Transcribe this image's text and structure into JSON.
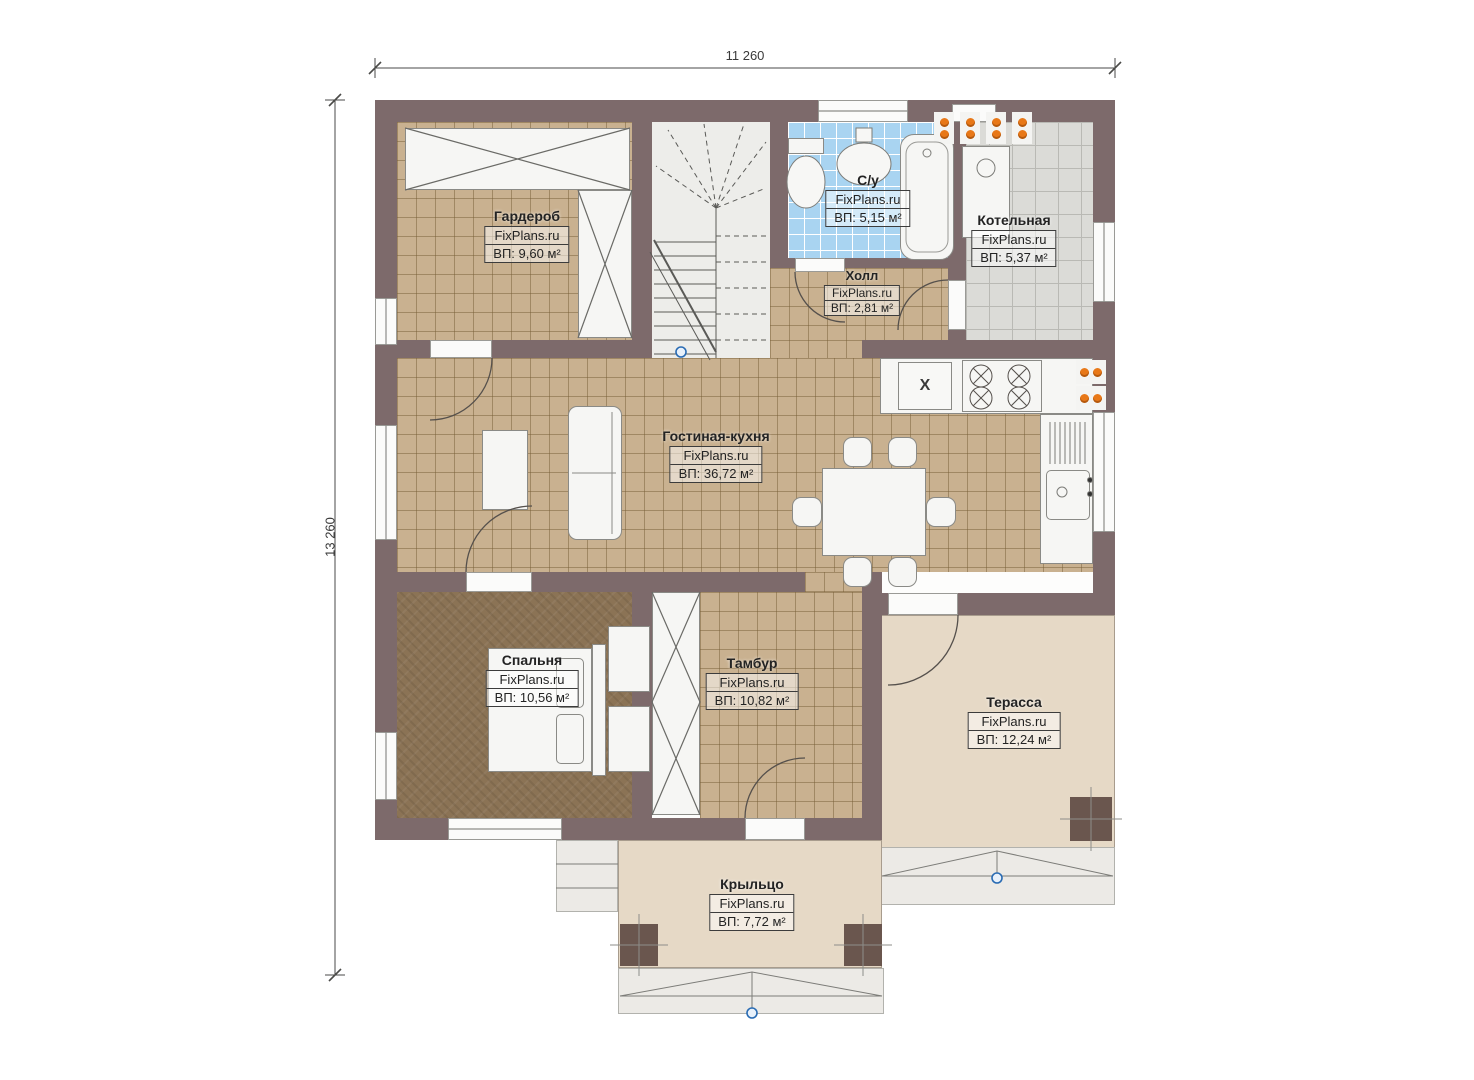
{
  "plan": {
    "kind": "first-floor plan",
    "watermark": "FixPlans.ru"
  },
  "dimensions": {
    "top": "11 260",
    "left": "13 260"
  },
  "rooms": [
    {
      "name": "Гардероб",
      "brand": "FixPlans.ru",
      "area": "ВП: 9,60 м²"
    },
    {
      "name": "С/у",
      "brand": "FixPlans.ru",
      "area": "ВП: 5,15 м²"
    },
    {
      "name": "Котельная",
      "brand": "FixPlans.ru",
      "area": "ВП: 5,37 м²"
    },
    {
      "name": "Холл",
      "brand": "FixPlans.ru",
      "area": "ВП: 2,81 м²"
    },
    {
      "name": "Гостиная-кухня",
      "brand": "FixPlans.ru",
      "area": "ВП: 36,72 м²"
    },
    {
      "name": "Спальня",
      "brand": "FixPlans.ru",
      "area": "ВП: 10,56 м²"
    },
    {
      "name": "Тамбур",
      "brand": "FixPlans.ru",
      "area": "ВП: 10,82 м²"
    },
    {
      "name": "Терасса",
      "brand": "FixPlans.ru",
      "area": "ВП: 12,24 м²"
    },
    {
      "name": "Крыльцо",
      "brand": "FixPlans.ru",
      "area": "ВП: 7,72 м²"
    }
  ],
  "symbols": {
    "fridge_mark": "X"
  },
  "colors": {
    "wall": "#7d6a6b",
    "floor_tan": "#c9b190",
    "floor_blue": "#a9d4f1",
    "floor_gray": "#dbdbd7",
    "carpet": "#8b7355",
    "terrace": "#e6d9c6",
    "radiator_orange": "#e87818",
    "marker_blue": "#2a6cb4"
  }
}
